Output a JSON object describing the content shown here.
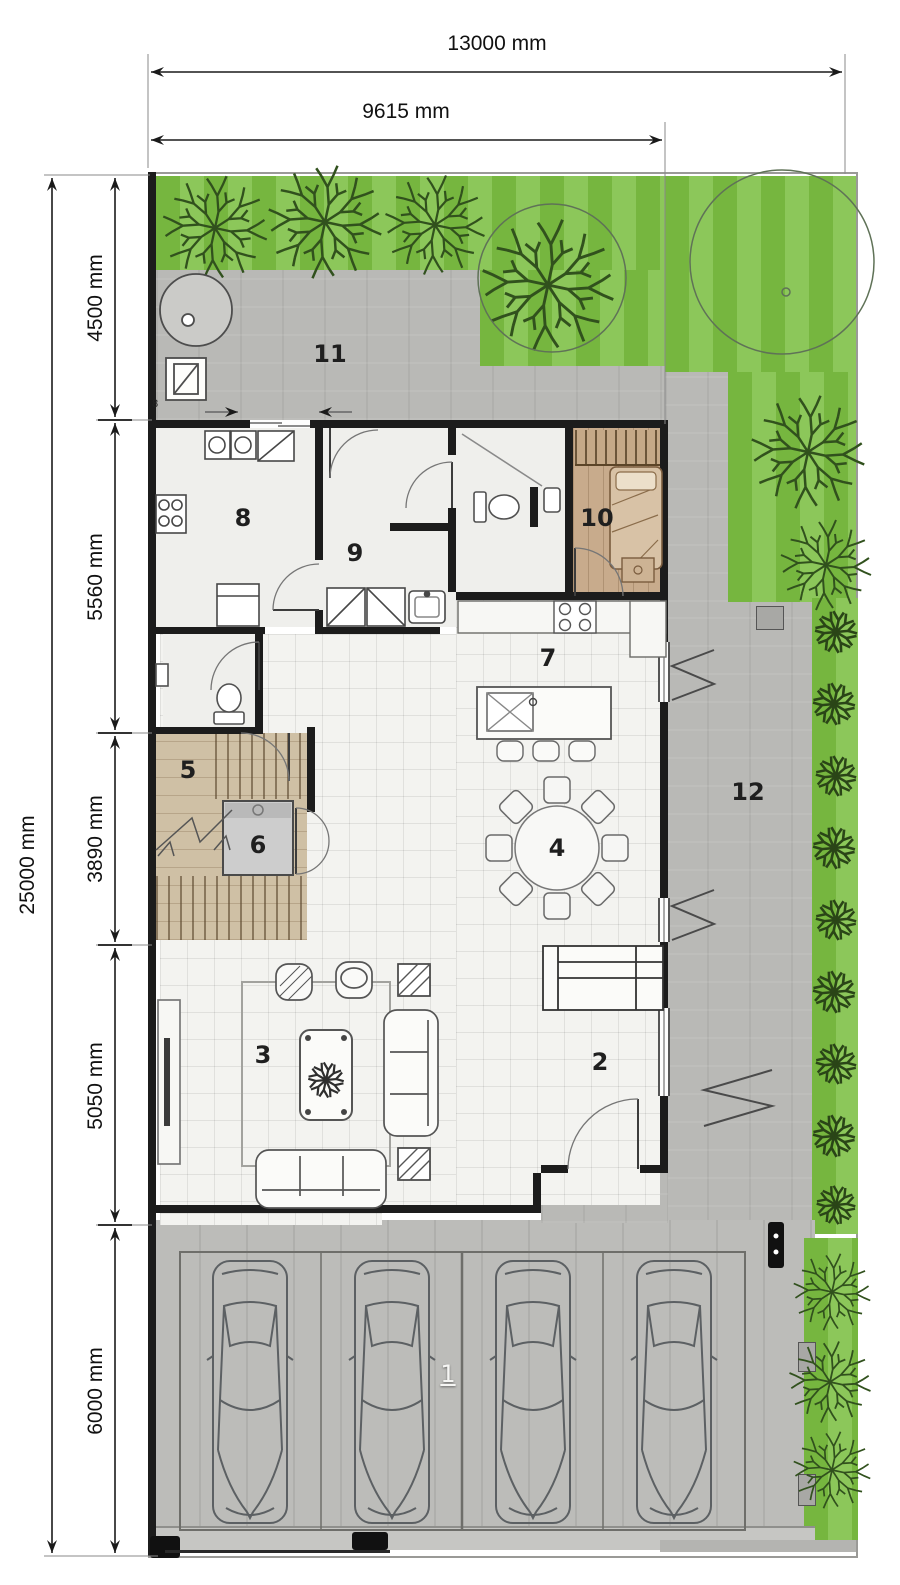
{
  "dims": {
    "top": [
      "13000 mm",
      "9615 mm"
    ],
    "left_total": "25000 mm",
    "left_segments": [
      "4500 mm",
      "5560 mm",
      "3890 mm",
      "5050 mm",
      "6000 mm"
    ]
  },
  "rooms": [
    {
      "number": "1"
    },
    {
      "number": "2"
    },
    {
      "number": "3"
    },
    {
      "number": "4"
    },
    {
      "number": "5"
    },
    {
      "number": "6"
    },
    {
      "number": "7"
    },
    {
      "number": "8"
    },
    {
      "number": "9"
    },
    {
      "number": "10"
    },
    {
      "number": "11"
    },
    {
      "number": "12"
    }
  ],
  "wall_tag": "8",
  "colors": {
    "grass_dark": "#76b63f",
    "grass_light": "#8cc75a",
    "paving": "#b9b9b6",
    "wall": "#1c1c1c",
    "floor_tile": "#f3f3f0",
    "wood_light": "#cfc0a5",
    "wood_bedroom": "#c8ab8c",
    "elevator": "#cdcdcd"
  }
}
